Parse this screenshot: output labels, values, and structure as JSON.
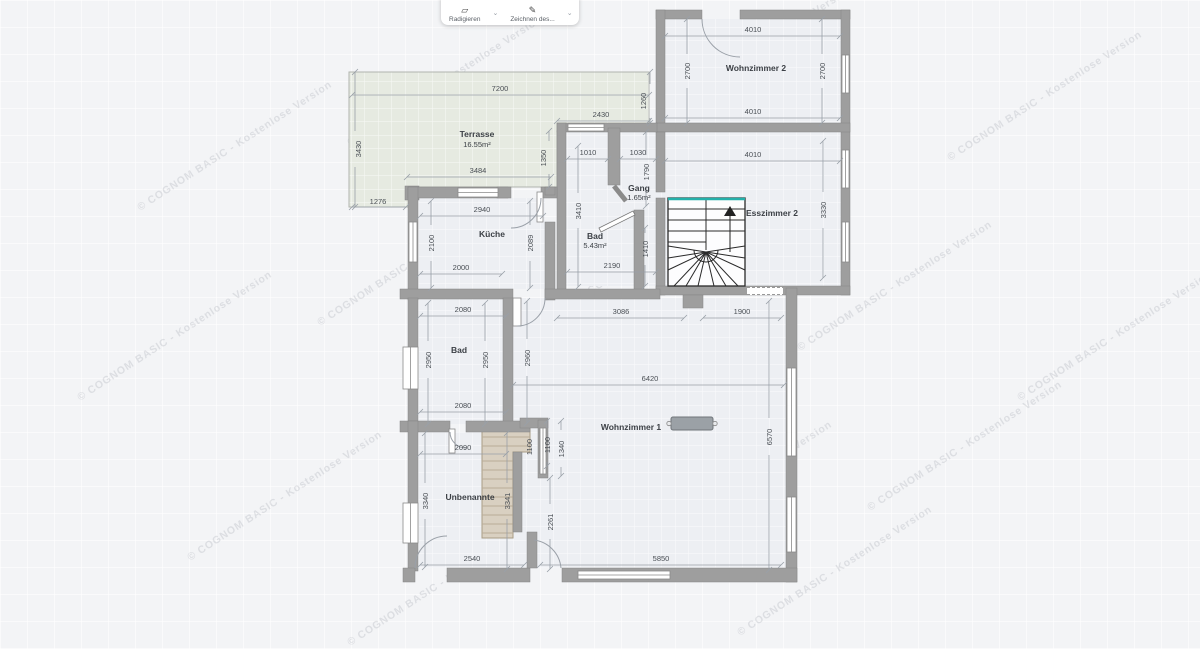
{
  "toolbar": {
    "buttons": [
      {
        "label": "Radigieren",
        "icon": "eraser-icon"
      },
      {
        "label": "Zeichnen des...",
        "icon": "pencil-icon"
      }
    ]
  },
  "watermark": "© COGNOM BASIC  -  Kostenlose Version",
  "rooms": {
    "terrasse": {
      "name": "Terrasse",
      "area": "16.55m²"
    },
    "wohnzimmer2": {
      "name": "Wohnzimmer 2"
    },
    "esszimmer2": {
      "name": "Esszimmer 2"
    },
    "gang": {
      "name": "Gang",
      "area": "1.65m²"
    },
    "bad_og": {
      "name": "Bad",
      "area": "5.43m²"
    },
    "kueche": {
      "name": "Küche"
    },
    "bad2": {
      "name": "Bad"
    },
    "wohnzimmer1": {
      "name": "Wohnzimmer 1"
    },
    "unbenannte": {
      "name": "Unbenannte"
    }
  },
  "dims": {
    "d7200": "7200",
    "d3430": "3430",
    "d3484": "3484",
    "d1276": "1276",
    "d1350": "1350",
    "d2430": "2430",
    "d1260": "1260",
    "d4010a": "4010",
    "d4010b": "4010",
    "d4010c": "4010",
    "d2700l": "2700",
    "d2700r": "2700",
    "d3330": "3330",
    "d1010": "1010",
    "d1030": "1030",
    "d1790": "1790",
    "d3410": "3410",
    "d1410": "1410",
    "d2190": "2190",
    "d2940": "2940",
    "d2100": "2100",
    "d2000": "2000",
    "d2089": "2089",
    "d3086": "3086",
    "d1900": "1900",
    "d2080a": "2080",
    "d2080b": "2080",
    "d2950l": "2950",
    "d2950r": "2950",
    "d2960": "2960",
    "d6420": "6420",
    "d6570": "6570",
    "d1100a": "1100",
    "d1100b": "1100",
    "d1340": "1340",
    "d2090": "2090",
    "d3340": "3340",
    "d3341": "3341",
    "d2261": "2261",
    "d2540": "2540",
    "d5850": "5850"
  },
  "colors": {
    "wall": "#9e9e9e",
    "room_fill": "#edeff3",
    "terrace_fill": "#e6eae1",
    "stair_wood": "#d9d0c1",
    "accent_teal": "#23b0aa",
    "dim_text": "#4a4f55"
  }
}
